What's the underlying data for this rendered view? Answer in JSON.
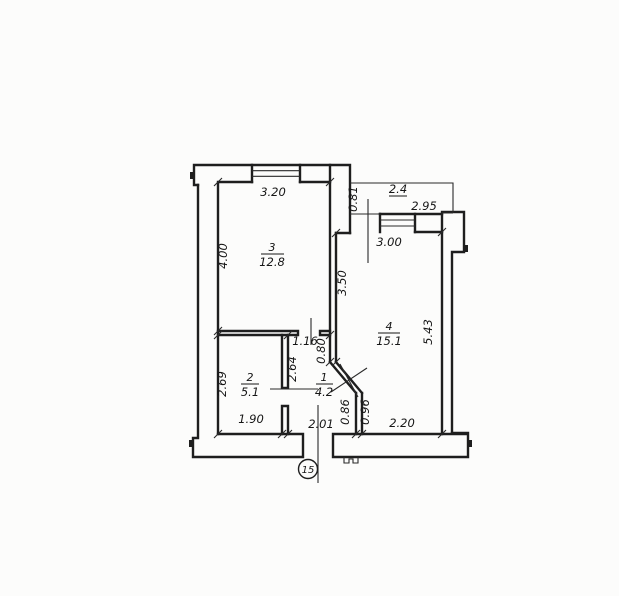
{
  "plan": {
    "unit_number": "15",
    "rooms": {
      "room1": {
        "number": "1",
        "area": "4.2"
      },
      "room2": {
        "number": "2",
        "area": "5.1"
      },
      "room3": {
        "number": "3",
        "area": "12.8"
      },
      "room4": {
        "number": "4",
        "area": "15.1"
      },
      "balcony": {
        "area": "2.4"
      }
    },
    "dimensions": {
      "room3_top": "3.20",
      "room3_left": "4.00",
      "room4_left": "3.50",
      "room4_top": "3.00",
      "balcony_door": "0.81",
      "balcony_width": "2.95",
      "room4_right": "5.43",
      "room2_left": "2.69",
      "hall_left_wall": "2.64",
      "hall_top": "1.16",
      "hall_right_upper": "0.80",
      "room2_bottom": "1.90",
      "hall_bottom": "2.01",
      "diag_lower_left": "0.86",
      "diag_lower_right": "0.96",
      "room4_bottom": "2.20"
    },
    "ink_color": "#1e1e1e",
    "paper_color": "#fcfcfb"
  }
}
